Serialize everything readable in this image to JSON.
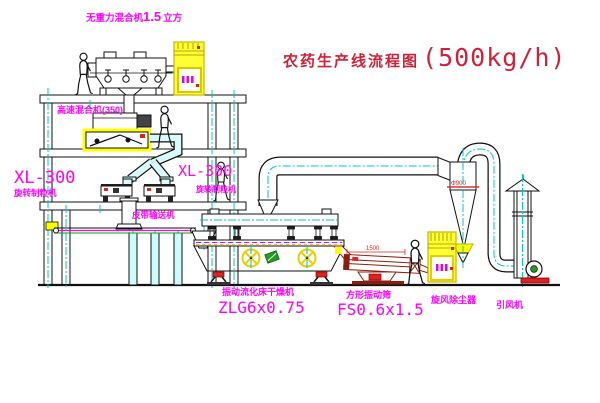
{
  "title": {
    "name": "农药生产线流程图",
    "capacity": "(500kg/h)"
  },
  "equipment_labels": {
    "gravity_mixer": {
      "name": "无重力混合机",
      "capacity": "1.5",
      "unit": "立方"
    },
    "high_speed_mixer": "高速混合机(350)",
    "granulator_left": {
      "model": "XL-300",
      "name": "旋转制粒机"
    },
    "granulator_right": {
      "model": "XL-300",
      "name": "旋转制粒机"
    },
    "belt_conveyor": "皮带输送机",
    "fluid_bed_dryer": {
      "name": "振动流化床干燥机",
      "model": "ZLG6x0.75"
    },
    "vibrating_screen": {
      "name": "方形振动筛",
      "model": "FS0.6x1.5"
    },
    "cyclone": "旋风除尘器",
    "induced_draft_fan": "引风机"
  },
  "dimensions": {
    "cyclone_diameter": "Φ900",
    "screen_length": "1500"
  },
  "colors": {
    "label_magenta": "#ff00ff",
    "title_red": "#ce2238",
    "centerline_cyan": "#00c6c6",
    "highlight_yellow": "#ffff00",
    "accent_red": "#dd2222",
    "line_black": "#111111",
    "screen_dark_red": "#8a1f10",
    "sticker_green": "#1f9d1f"
  }
}
